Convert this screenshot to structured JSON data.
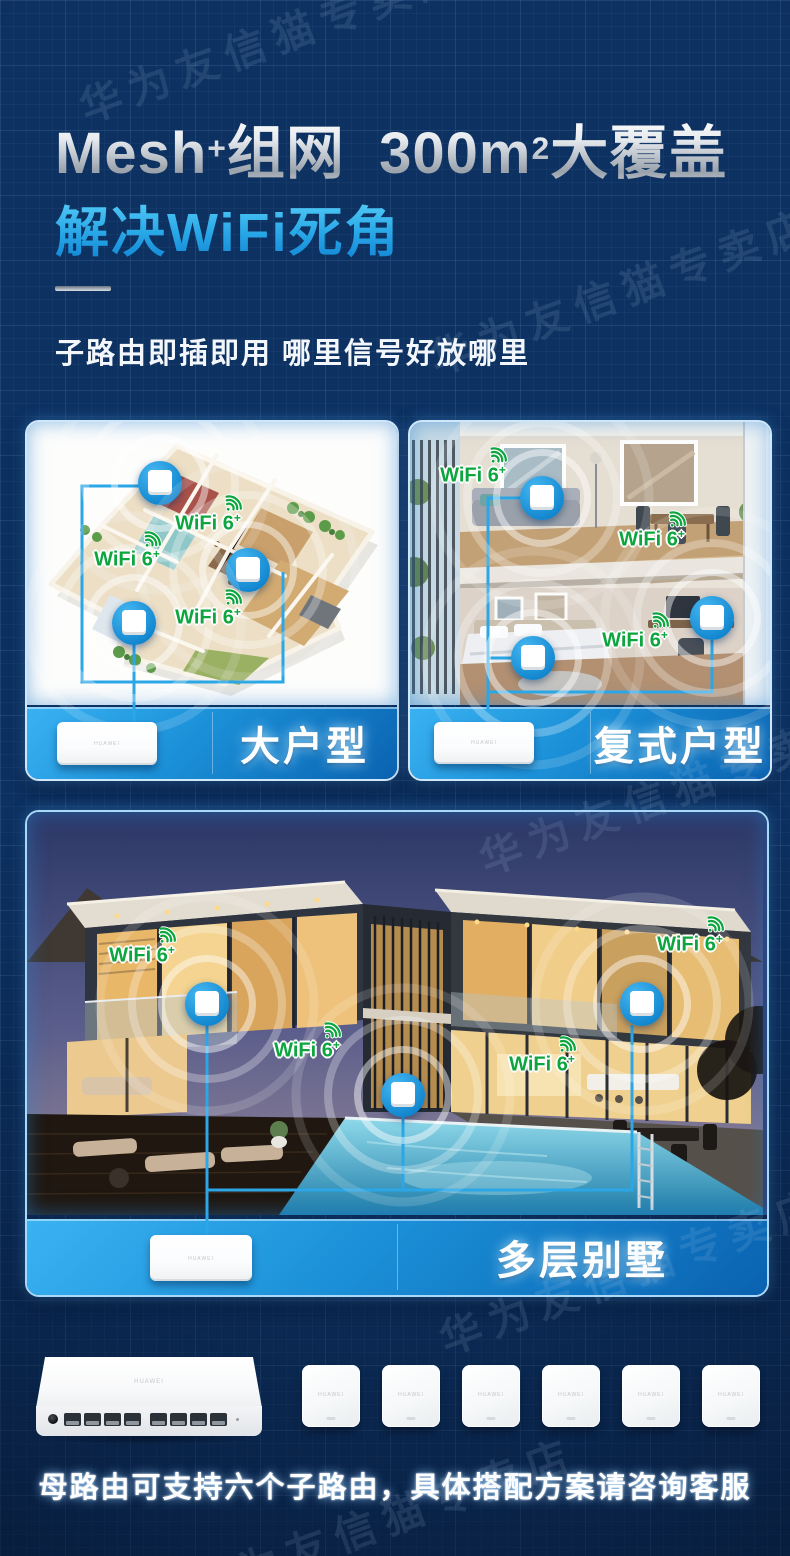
{
  "colors": {
    "background": "#0d3161",
    "accent_blue": "#1b9ad6",
    "wifi_green": "#0ca53e",
    "strip_gradient_top": "#3ab2f2",
    "strip_gradient_bottom": "#0a62b0"
  },
  "watermark": {
    "text": "华为友信猫专卖店"
  },
  "hero": {
    "title": {
      "latin": "Mesh",
      "sup1": "+",
      "mid": "组网  300m",
      "sup2": "2",
      "tail": "大覆盖"
    },
    "subtitle": "解决WiFi死角",
    "tagline": "子路由即插即用 哪里信号好放哪里"
  },
  "wifi_badge": {
    "label": "WiFi 6",
    "sup": "+"
  },
  "cards": {
    "large_home": {
      "label": "大户型"
    },
    "duplex_home": {
      "label": "复式户型"
    },
    "villa": {
      "label": "多层别墅"
    }
  },
  "products": {
    "brand": "HUAWEI",
    "caption": "母路由可支持六个子路由，具体搭配方案请咨询客服"
  }
}
